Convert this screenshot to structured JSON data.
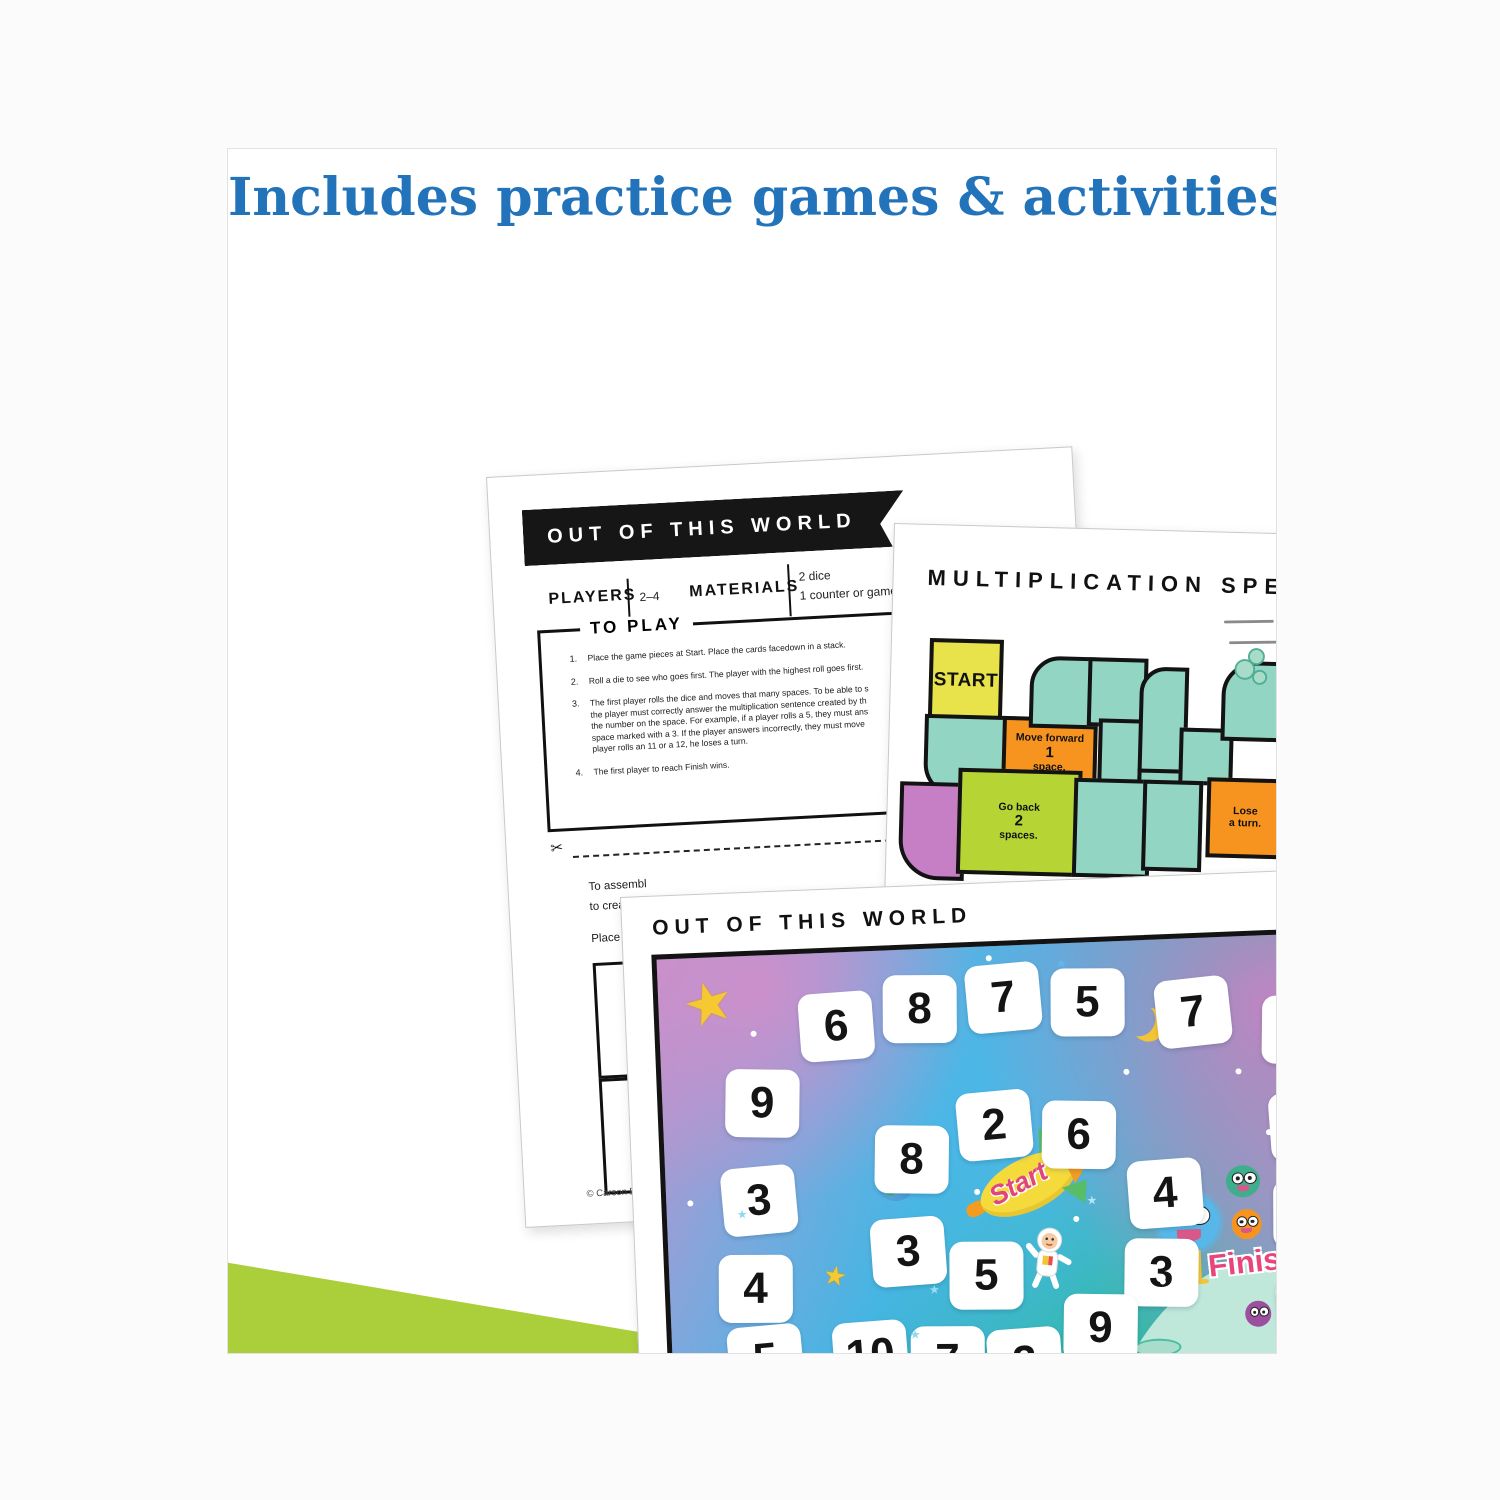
{
  "header": {
    "prefix": "Includes ",
    "highlighted": "practice games & activities"
  },
  "instructions_page": {
    "banner_title": "OUT OF THIS WORLD",
    "players_label": "PLAYERS",
    "players_value": "2–4",
    "materials_label": "MATERIALS",
    "materials_items": [
      "2 dice",
      "1 counter or game"
    ],
    "to_play_label": "TO PLAY",
    "steps": [
      {
        "num": "1.",
        "lines": [
          "Place the game pieces at Start. Place the cards facedown in a stack."
        ]
      },
      {
        "num": "2.",
        "lines": [
          "Roll a die to see who goes first. The player with the highest roll goes first."
        ]
      },
      {
        "num": "3.",
        "lines": [
          "The first player rolls the dice and moves that many spaces. To be able to s",
          "the player must correctly answer the multiplication sentence created by th",
          "the number on the space. For example, if a player rolls a 5, they must ans",
          "space marked with a 3. If the player answers incorrectly, they must move",
          "player rolls an 11 or a 12, he loses a turn."
        ]
      },
      {
        "num": "4.",
        "lines": [
          "The first player to reach Finish wins."
        ]
      }
    ],
    "assembly_fragments": [
      "To assembl",
      "to create a",
      "Place a bind"
    ],
    "copyright": "© Carson Dellosa • CD-"
  },
  "speedway_page": {
    "title": "MULTIPLICATION SPEEDWAY",
    "car_number": "18",
    "footer": "Games & Activities",
    "segments": [
      {
        "x": 6.5,
        "y": 15,
        "w": 11.5,
        "h": 10,
        "c": "yellow",
        "cls": "start",
        "label": [
          "START"
        ]
      },
      {
        "x": 6,
        "y": 25,
        "w": 13.5,
        "h": 10,
        "c": "teal",
        "rad": "0 0 0 34px"
      },
      {
        "x": 19.5,
        "y": 25,
        "w": 15,
        "h": 8.6,
        "c": "orange",
        "label": [
          "Move forward",
          "1",
          "space."
        ],
        "big": 1
      },
      {
        "x": 24,
        "y": 17,
        "w": 10,
        "h": 8.4,
        "c": "teal",
        "rad": "30px 0 0 0"
      },
      {
        "x": 34,
        "y": 17,
        "w": 9,
        "h": 8,
        "c": "teal"
      },
      {
        "x": 36,
        "y": 25,
        "w": 8,
        "h": 8.6,
        "c": "teal"
      },
      {
        "x": 43,
        "y": 18,
        "w": 7,
        "h": 14,
        "c": "teal",
        "rad": "26px 0 0 0"
      },
      {
        "x": 43,
        "y": 31.5,
        "w": 9,
        "h": 8,
        "c": "teal",
        "rad": "0 0 0 30px"
      },
      {
        "x": 50,
        "y": 26,
        "w": 8,
        "h": 6.5,
        "c": "teal"
      },
      {
        "x": 55,
        "y": 32.5,
        "w": 12,
        "h": 9.5,
        "c": "orange",
        "label": [
          "Lose",
          "a turn."
        ]
      },
      {
        "x": 57,
        "y": 17,
        "w": 13,
        "h": 9.5,
        "c": "teal",
        "rad": "34px 0 0 0"
      },
      {
        "x": 70,
        "y": 17,
        "w": 13,
        "h": 9.5,
        "c": "teal",
        "rad": "0 34px 0 0"
      },
      {
        "x": 83,
        "y": 22,
        "w": 10,
        "h": 9.5,
        "c": "teal"
      },
      {
        "x": 83,
        "y": 31.5,
        "w": 10,
        "h": 15.5,
        "c": "purple"
      },
      {
        "x": 82,
        "y": 47,
        "w": 10,
        "h": 13,
        "c": "teal"
      },
      {
        "x": 81,
        "y": 60,
        "w": 9,
        "h": 7,
        "c": "green",
        "rad": "40px 40px 0 0"
      },
      {
        "x": 81,
        "y": 67,
        "w": 10,
        "h": 9,
        "c": "teal"
      },
      {
        "x": 81,
        "y": 76,
        "w": 10,
        "h": 11.5,
        "c": "purple",
        "cls": "finish",
        "label": [
          "FINISH"
        ]
      },
      {
        "x": 2,
        "y": 34,
        "w": 10,
        "h": 12,
        "c": "purple",
        "rad": "0 0 0 40px"
      },
      {
        "x": 12,
        "y": 32,
        "w": 20,
        "h": 13,
        "c": "green",
        "label": [
          "Go back",
          "2",
          "spaces."
        ],
        "big": 1
      },
      {
        "x": 32,
        "y": 33,
        "w": 12,
        "h": 12,
        "c": "teal"
      },
      {
        "x": 44,
        "y": 33,
        "w": 9,
        "h": 11,
        "c": "teal"
      }
    ]
  },
  "board_page": {
    "title": "OUT OF THIS WORLD",
    "start_label": "Start",
    "finish_label": "Finish",
    "copyright": "© Carson Dellosa • CD-109680",
    "footer": "Games & Activities",
    "tiles": [
      {
        "v": "6",
        "x": 20,
        "y": 9,
        "r": -2
      },
      {
        "v": "8",
        "x": 32,
        "y": 6,
        "r": 2
      },
      {
        "v": "7",
        "x": 44,
        "y": 4,
        "r": -3
      },
      {
        "v": "5",
        "x": 56,
        "y": 6,
        "r": 2
      },
      {
        "v": "7",
        "x": 71,
        "y": 9,
        "r": -4
      },
      {
        "v": "4",
        "x": 86,
        "y": 14,
        "r": 3
      },
      {
        "v": "9",
        "x": 86.5,
        "y": 36,
        "r": -2
      },
      {
        "v": "6",
        "x": 86.5,
        "y": 56,
        "r": 2
      },
      {
        "v": "8",
        "x": 86.5,
        "y": 78,
        "r": -2
      },
      {
        "v": "9",
        "x": 9,
        "y": 26,
        "r": 3
      },
      {
        "v": "3",
        "x": 8,
        "y": 48,
        "r": -3
      },
      {
        "v": "4",
        "x": 7,
        "y": 68,
        "r": 2
      },
      {
        "v": "5",
        "x": 8,
        "y": 84,
        "r": -3
      },
      {
        "v": "8",
        "x": 30,
        "y": 40,
        "r": 3
      },
      {
        "v": "2",
        "x": 42,
        "y": 33,
        "r": -3
      },
      {
        "v": "6",
        "x": 54,
        "y": 36,
        "r": 3
      },
      {
        "v": "3",
        "x": 29,
        "y": 61,
        "r": -2
      },
      {
        "v": "5",
        "x": 40,
        "y": 67,
        "r": 2
      },
      {
        "v": "4",
        "x": 66,
        "y": 50,
        "r": -2
      },
      {
        "v": "3",
        "x": 65,
        "y": 68,
        "r": 3
      },
      {
        "v": "10",
        "x": 23,
        "y": 84,
        "r": -2
      },
      {
        "v": "7",
        "x": 34,
        "y": 86,
        "r": 2
      },
      {
        "v": "2",
        "x": 45,
        "y": 87,
        "r": -2
      },
      {
        "v": "9",
        "x": 56,
        "y": 80,
        "r": 3
      }
    ],
    "dots": [
      {
        "x": 27,
        "y": 12
      },
      {
        "x": 47,
        "y": 2
      },
      {
        "x": 66,
        "y": 29
      },
      {
        "x": 78,
        "y": 10
      },
      {
        "x": 91,
        "y": 28
      },
      {
        "x": 17,
        "y": 38
      },
      {
        "x": 3,
        "y": 55
      },
      {
        "x": 44,
        "y": 55
      },
      {
        "x": 62,
        "y": 91
      },
      {
        "x": 49,
        "y": 96
      },
      {
        "x": 86,
        "y": 44
      },
      {
        "x": 94,
        "y": 66
      },
      {
        "x": 30,
        "y": 96
      },
      {
        "x": 13,
        "y": 17
      },
      {
        "x": 70,
        "y": 77
      },
      {
        "x": 82,
        "y": 30
      },
      {
        "x": 58,
        "y": 62
      }
    ],
    "mini_stars": [
      {
        "x": 57,
        "y": 3,
        "c": "#5bb9ee"
      },
      {
        "x": 34,
        "y": 86,
        "c": "#8fd9ee"
      },
      {
        "x": 10,
        "y": 57,
        "c": "#8fd9ee"
      },
      {
        "x": 60,
        "y": 57,
        "c": "#b7e3f2"
      },
      {
        "x": 37,
        "y": 76,
        "c": "#9adcf0"
      }
    ]
  },
  "colors": {
    "header_text": "#2273b9",
    "header_highlight": "#a9d9f4",
    "teal": "#92d5c3",
    "orange": "#f79420",
    "green": "#b6d434",
    "purple": "#c67ec4",
    "yellow": "#e9e34b",
    "finish_pink": "#e8457d",
    "card_green": "#aacf3a",
    "card_purple": "#bf7cbc"
  }
}
